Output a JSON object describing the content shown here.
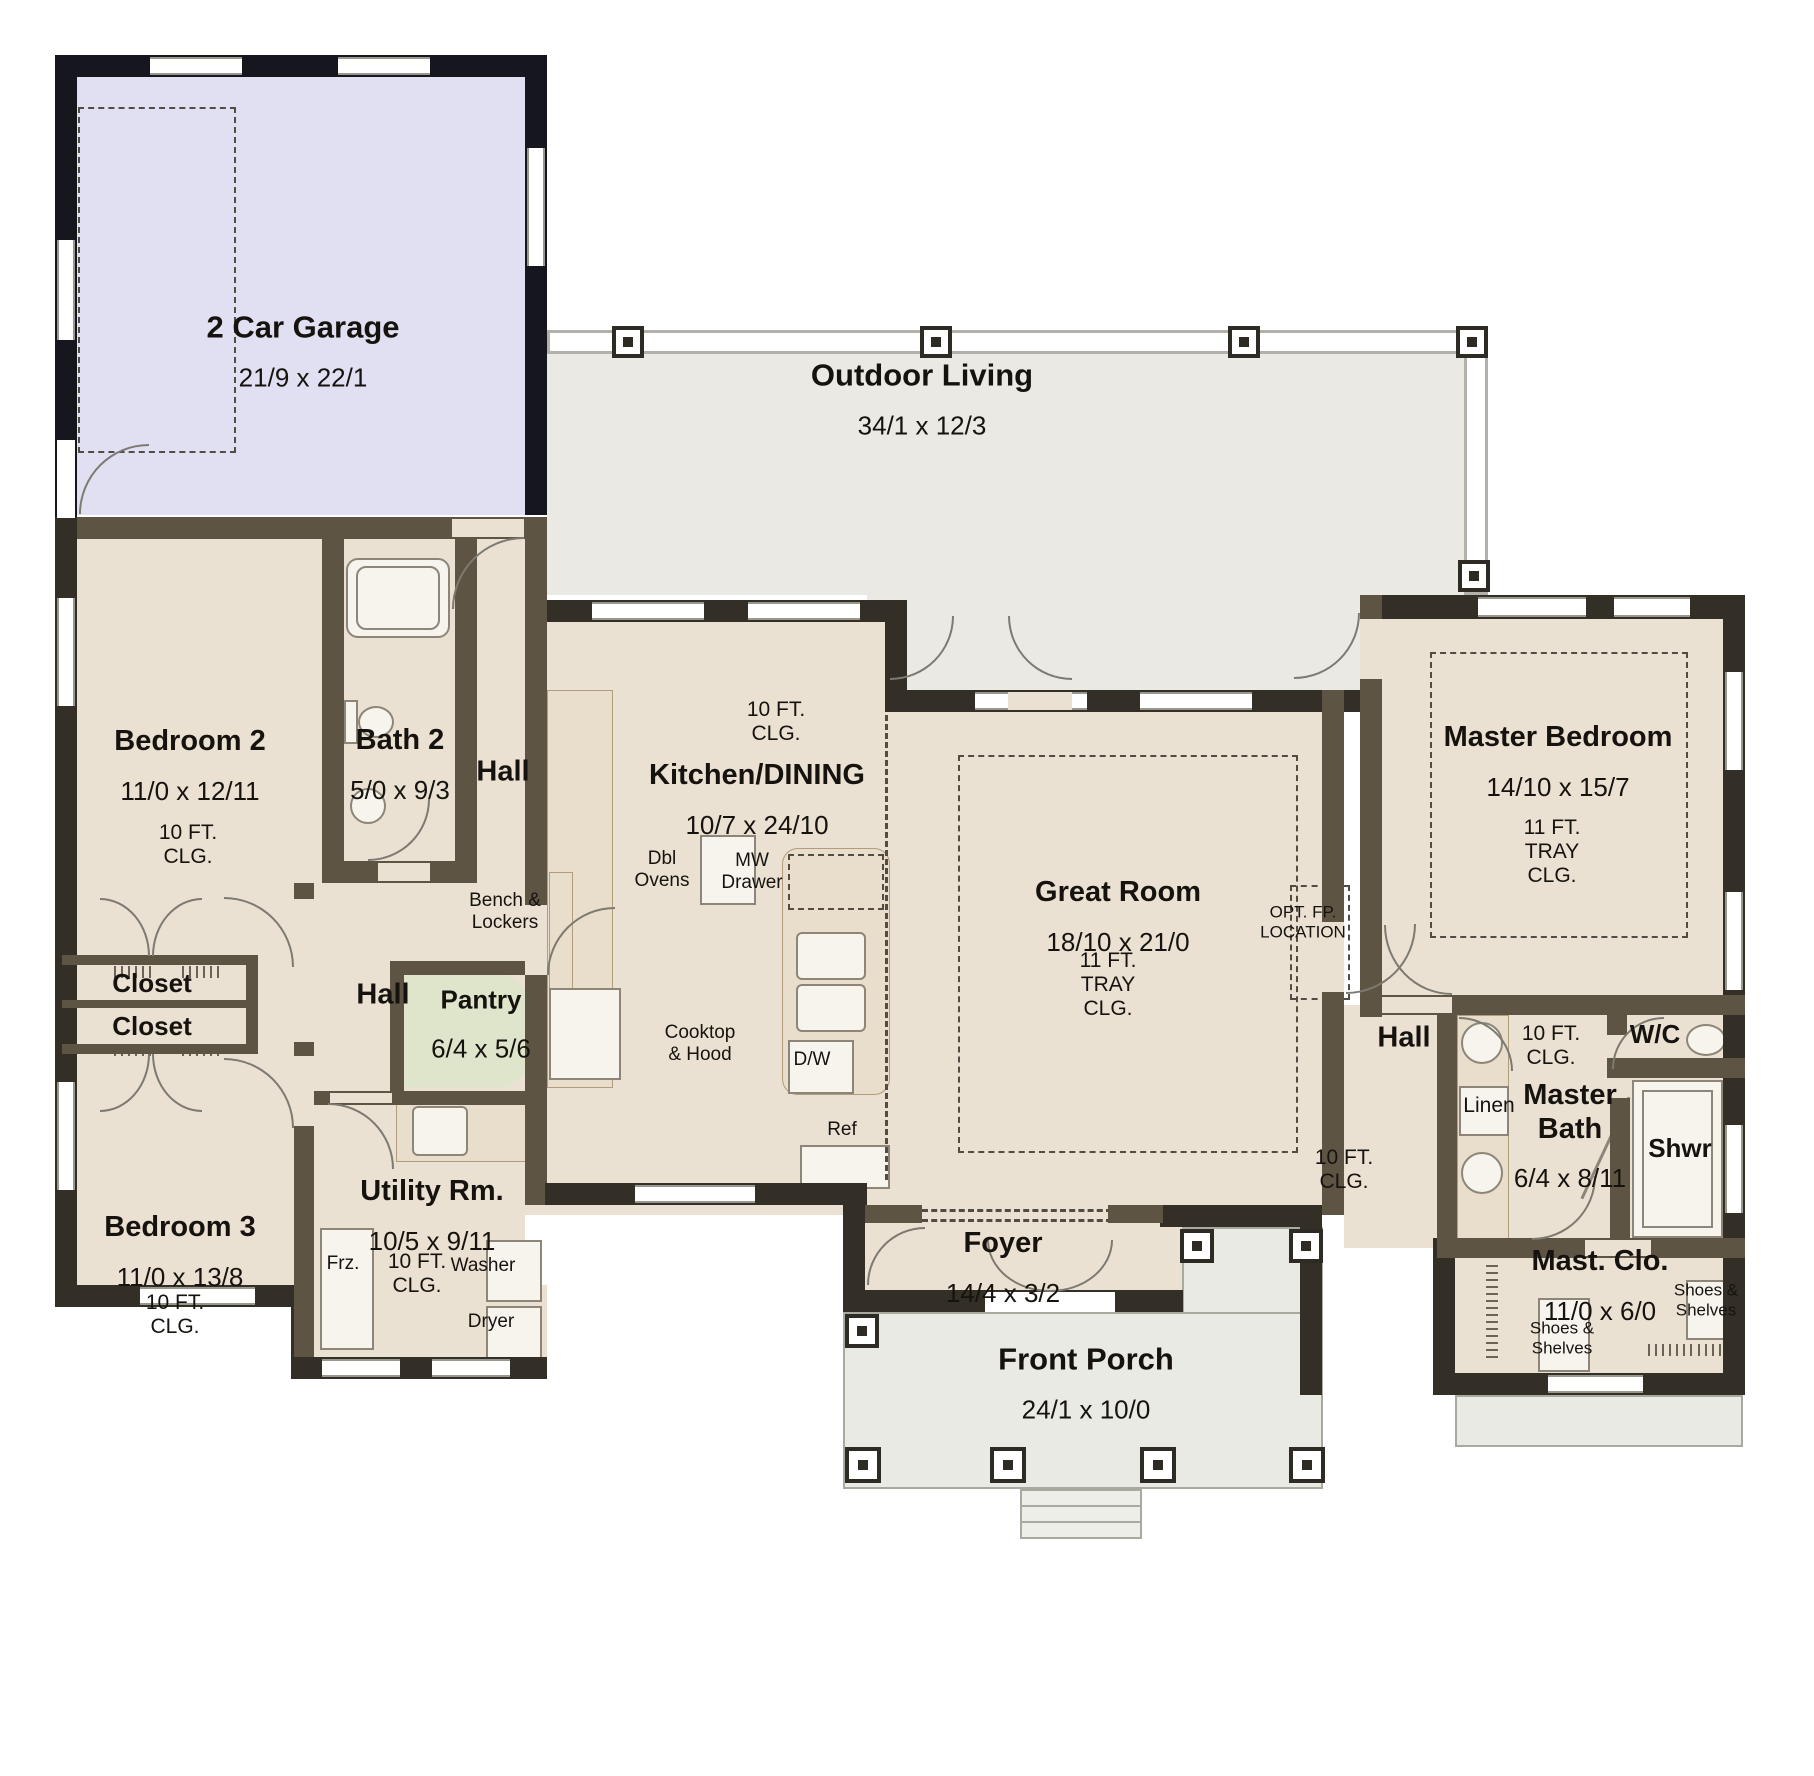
{
  "meta": {
    "type": "house-floor-plan"
  },
  "rooms": {
    "garage": {
      "label": "2 Car Garage",
      "dims": "21/9 x 22/1"
    },
    "outdoor_living": {
      "label": "Outdoor Living",
      "dims": "34/1 x 12/3"
    },
    "bedroom2": {
      "label": "Bedroom 2",
      "dims": "11/0 x 12/11",
      "ceiling": "10 FT.\nCLG."
    },
    "bath2": {
      "label": "Bath 2",
      "dims": "5/0 x 9/3"
    },
    "hall_top": {
      "label": "Hall"
    },
    "hall_mid": {
      "label": "Hall"
    },
    "hall_right": {
      "label": "Hall",
      "ceiling": "10 FT.\nCLG."
    },
    "kitchen": {
      "label": "Kitchen/DINING",
      "dims": "10/7 x 24/10",
      "ceiling": "10 FT.\nCLG."
    },
    "great_room": {
      "label": "Great Room",
      "dims": "18/10 x 21/0",
      "ceiling": "11 FT.\nTRAY\nCLG."
    },
    "master_bedroom": {
      "label": "Master Bedroom",
      "dims": "14/10 x 15/7",
      "ceiling": "11 FT.\nTRAY\nCLG."
    },
    "pantry": {
      "label": "Pantry",
      "dims": "6/4 x 5/6"
    },
    "closet_a": {
      "label": "Closet"
    },
    "closet_b": {
      "label": "Closet"
    },
    "bedroom3": {
      "label": "Bedroom 3",
      "dims": "11/0 x 13/8",
      "ceiling": "10 FT.\nCLG."
    },
    "utility": {
      "label": "Utility Rm.",
      "dims": "10/5 x 9/11",
      "ceiling": "10 FT.\nCLG."
    },
    "foyer": {
      "label": "Foyer",
      "dims": "14/4 x 3/2"
    },
    "front_porch": {
      "label": "Front Porch",
      "dims": "24/1 x 10/0"
    },
    "master_bath": {
      "label": "Master\nBath",
      "dims": "6/4 x 8/11",
      "ceiling": "10 FT.\nCLG."
    },
    "wc": {
      "label": "W/C"
    },
    "shower": {
      "label": "Shwr"
    },
    "linen": {
      "label": "Linen"
    },
    "master_closet": {
      "label": "Mast. Clo.",
      "dims": "11/0 x 6/0"
    }
  },
  "annotations": {
    "bench_lockers": "Bench &\nLockers",
    "dbl_ovens": "Dbl\nOvens",
    "mw_drawer": "MW\nDrawer",
    "cooktop_hood": "Cooktop\n& Hood",
    "dishwasher": "D/W",
    "fridge": "Ref",
    "opt_fireplace": "OPT. FP.\nLOCATION",
    "freezer": "Frz.",
    "washer": "Washer",
    "dryer": "Dryer",
    "shoes_shelves_a": "Shoes &\nShelves",
    "shoes_shelves_b": "Shoes &\nShelves"
  },
  "colors": {
    "garage_floor": "#e1e0f2",
    "interior_floor": "#eae1d3",
    "outdoor_floor": "#eae9e4",
    "pantry_floor": "#dfe5cb",
    "porch_floor": "#eaeae5",
    "wall_garage": "#16161f",
    "wall_exterior": "#332e26",
    "wall_interior": "#5d5444",
    "text": "#16130f"
  }
}
